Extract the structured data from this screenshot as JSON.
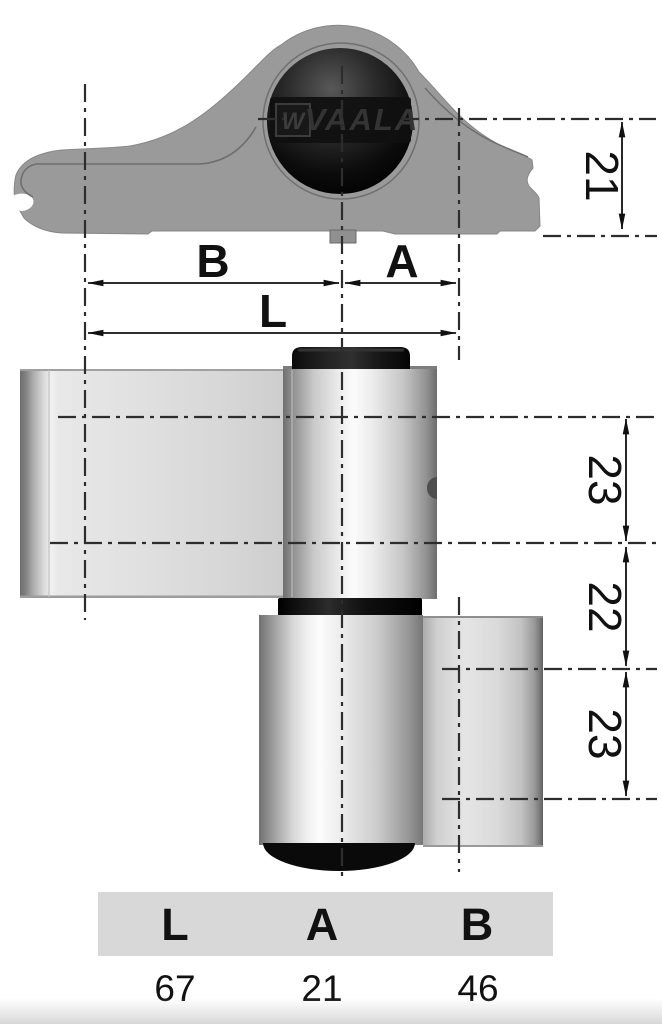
{
  "view": "door-hinge-technical-drawing",
  "top_view": {
    "logo_box": "W",
    "logo_text": "VAALA"
  },
  "dimensions": {
    "vertical_offset": "21",
    "b": "B",
    "a": "A",
    "l": "L",
    "segment_top": "23",
    "segment_middle": "22",
    "segment_bottom": "23"
  },
  "table": {
    "headers": [
      "L",
      "A",
      "B"
    ],
    "values": [
      "67",
      "21",
      "46"
    ]
  },
  "colors": {
    "profile_gray": "#9a9a9a",
    "knuckle_black": "#0a0a0a",
    "table_band": "#d8d8d8",
    "dimension_line": "#1a1a1a",
    "metal_highlight": "#fbfbfb"
  }
}
